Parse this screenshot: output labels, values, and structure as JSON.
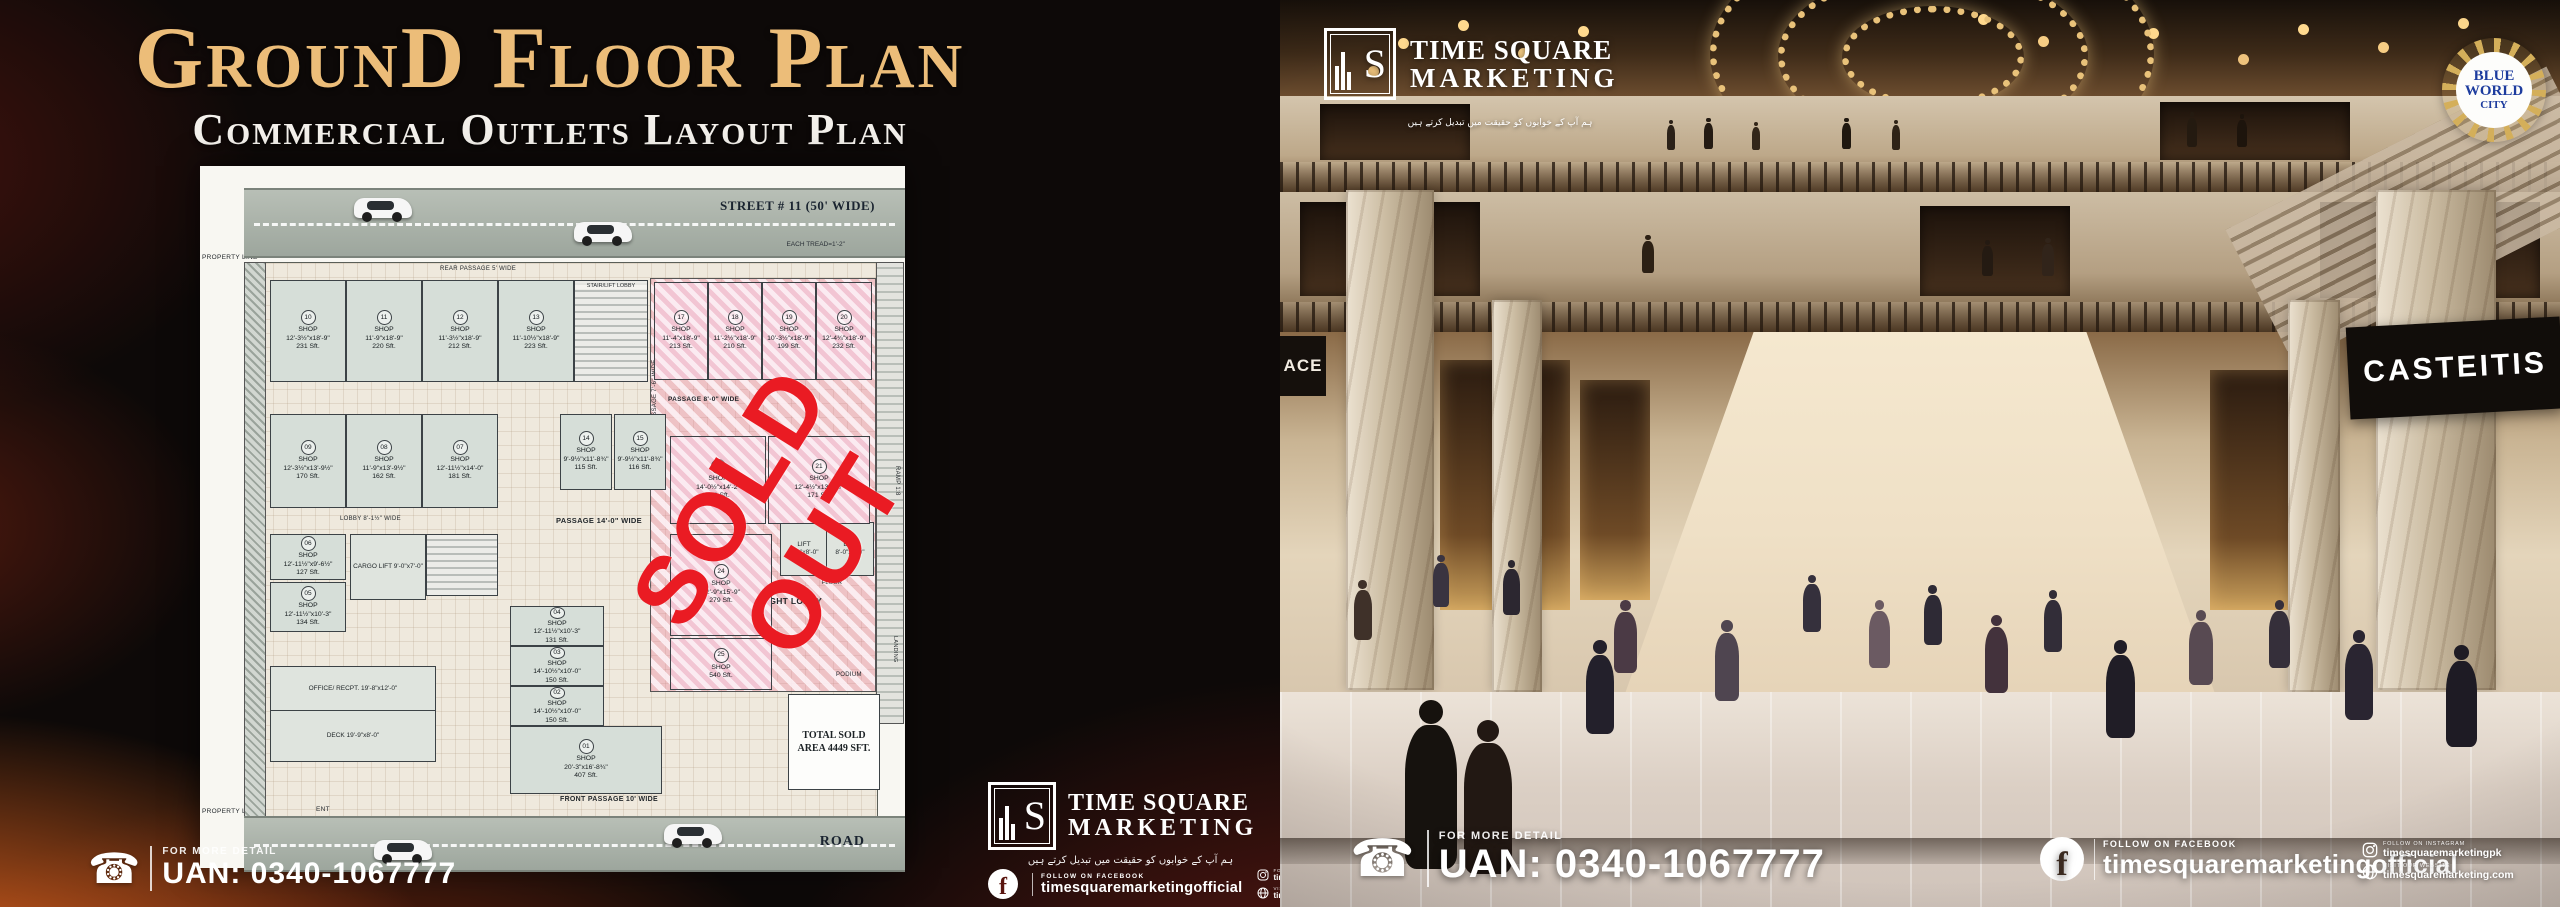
{
  "left_panel": {
    "title": "GrounD Floor Plan",
    "subtitle": "Commercial Outlets Layout Plan",
    "contact": {
      "caption": "FOR MORE DETAIL",
      "uan": "UAN: 0340-1067777"
    }
  },
  "floor_plan": {
    "street_label": "STREET # 11 (50' WIDE)",
    "each_tread": "EACH TREAD=1'-2\"",
    "rear_passage": "REAR PASSAGE 5' WIDE",
    "property_line": "PROPERTY LINE",
    "stair_lobby": "STAIR/LIFT LOBBY",
    "passage_8": "PASSAGE 8'-0\" WIDE",
    "passage_76": "PASSAGE 7'-6\" WIDE",
    "passage_14": "PASSAGE 14'-0\" WIDE",
    "lobby_8": "LOBBY 8'-1½\" WIDE",
    "double_height_lobby": "DOUBLE HEIGHT LOBBY",
    "cargo_lift": "CARGO LIFT 9'-0\"x7'-0\"",
    "lift": "LIFT 8'-0\"x8'-0\"",
    "office": "OFFICE/ RECPT. 19'-8\"x12'-0\"",
    "deck": "DECK 19'-9\"x8'-0\"",
    "front_passage": "FRONT PASSAGE 10' WIDE",
    "ent": "ENT",
    "in_label": "IN",
    "up": "UP",
    "road_label": "ROAD",
    "ramp": "RAMP 1:8",
    "landing": "LANDING",
    "podium": "PODIUM",
    "to_first_floor": "TO FIRST FLOOR",
    "total_sold": "TOTAL SOLD AREA 4449 SFT.",
    "sold_out": "SOLD OUT",
    "shops": [
      {
        "no": "01",
        "dims": "20'-3\"x16'-8¾\"",
        "area": "407 Sft."
      },
      {
        "no": "02",
        "dims": "14'-10½\"x10'-0\"",
        "area": "150 Sft."
      },
      {
        "no": "03",
        "dims": "14'-10½\"x10'-0\"",
        "area": "150 Sft."
      },
      {
        "no": "04",
        "dims": "12'-11½\"x10'-3\"",
        "area": "131 Sft."
      },
      {
        "no": "05",
        "dims": "12'-11½\"x10'-3\"",
        "area": "134 Sft."
      },
      {
        "no": "06",
        "dims": "12'-11½\"x9'-6½\"",
        "area": "127 Sft."
      },
      {
        "no": "07",
        "dims": "12'-11½\"x14'-0\"",
        "area": "181 Sft."
      },
      {
        "no": "08",
        "dims": "11'-9\"x13'-9½\"",
        "area": "162 Sft."
      },
      {
        "no": "09",
        "dims": "12'-3½\"x13'-9½\"",
        "area": "170 Sft."
      },
      {
        "no": "10",
        "dims": "12'-3½\"x18'-9\"",
        "area": "231 Sft."
      },
      {
        "no": "11",
        "dims": "11'-9\"x18'-9\"",
        "area": "220 Sft."
      },
      {
        "no": "12",
        "dims": "11'-3½\"x18'-9\"",
        "area": "212 Sft."
      },
      {
        "no": "13",
        "dims": "11'-10½\"x18'-9\"",
        "area": "223 Sft."
      },
      {
        "no": "14",
        "dims": "9'-9½\"x11'-8¾\"",
        "area": "115 Sft."
      },
      {
        "no": "15",
        "dims": "9'-9½\"x11'-8¾\"",
        "area": "116 Sft."
      },
      {
        "no": "17",
        "dims": "11'-4\"x18'-9\"",
        "area": "213 Sft."
      },
      {
        "no": "18",
        "dims": "11'-2½\"x18'-9\"",
        "area": "210 Sft."
      },
      {
        "no": "19",
        "dims": "10'-3½\"x18'-9\"",
        "area": "199 Sft."
      },
      {
        "no": "20",
        "dims": "12'-4¾\"x18'-9\"",
        "area": "232 Sft."
      },
      {
        "no": "22",
        "dims": "14'-0½\"x14'-2\"",
        "area": "199 Sft."
      },
      {
        "no": "21",
        "dims": "12'-4½\"x13'-8½\"",
        "area": "171 Sft."
      },
      {
        "no": "24",
        "dims": "12'-9\"x15'-9\"",
        "area": "279 Sft."
      },
      {
        "no": "25",
        "dims": "",
        "area": "540 Sft."
      }
    ]
  },
  "brand": {
    "monogram": "S",
    "name_line1": "TIME SQUARE",
    "name_line2": "MARKETING",
    "urdu_tagline": "ہم آپ کے خوابوں کو حقیقت میں تبدیل کرتے ہیں"
  },
  "social": {
    "facebook_caption": "FOLLOW ON FACEBOOK",
    "facebook_handle": "timesquaremarketingofficial",
    "facebook_letter": "f",
    "instagram_caption": "FOLLOW ON INSTAGRAM",
    "instagram_handle": "timesquaremarketingpk",
    "website_caption": "VISIT OUR WEBSITE",
    "website_handle": "timesquaremarketing.com"
  },
  "right_panel": {
    "badge": {
      "line1": "BLUE",
      "line2": "WORLD",
      "line3": "CITY"
    },
    "store_sign": "CASTEITIS",
    "partial_sign": "ACE",
    "contact": {
      "caption": "FOR MORE DETAIL",
      "uan": "UAN: 0340-1067777"
    }
  },
  "colors": {
    "accent_gold": "#ecbd79",
    "sold_out_red": "#ea1b23",
    "orange_glow": "#f06a20",
    "badge_blue": "#1d3c9e"
  }
}
